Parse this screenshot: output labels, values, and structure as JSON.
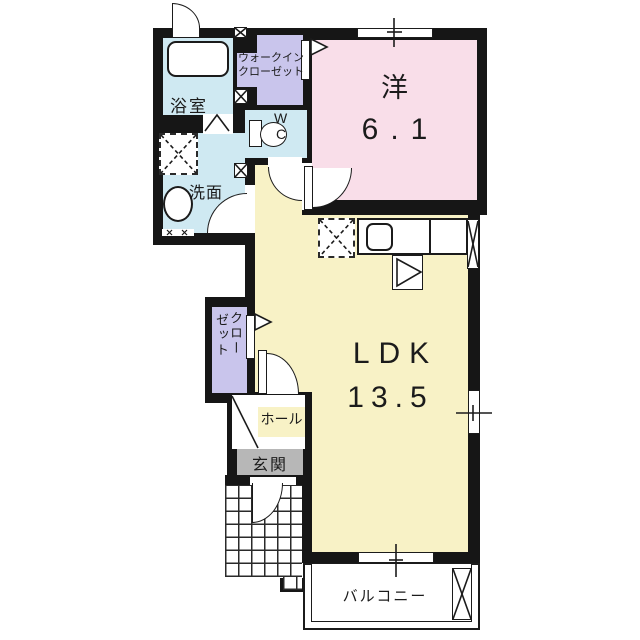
{
  "floorplan": {
    "rooms": {
      "bathroom": {
        "label": "浴室"
      },
      "walk_in_closet": {
        "label_line1": "ウォークイン",
        "label_line2": "クローゼット"
      },
      "wc": {
        "label_line1": "W",
        "label_line2": "C"
      },
      "washroom": {
        "label": "洗面"
      },
      "western_room": {
        "label": "洋",
        "size": "6.1"
      },
      "ldk": {
        "label": "LDK",
        "size": "13.5"
      },
      "closet": {
        "label_col_right": "クロー",
        "label_col_left": "ゼット"
      },
      "hall": {
        "label": "ホール"
      },
      "entrance": {
        "label": "玄関"
      },
      "balcony": {
        "label": "バルコニー"
      }
    },
    "colors": {
      "wall": "#161616",
      "water_rooms": "#cfe9f2",
      "closet_purple": "#c9c5ec",
      "bedroom_pink": "#f9dee9",
      "ldk_yellow": "#f8f2c6",
      "entrance_gray": "#b7b7b7"
    }
  }
}
